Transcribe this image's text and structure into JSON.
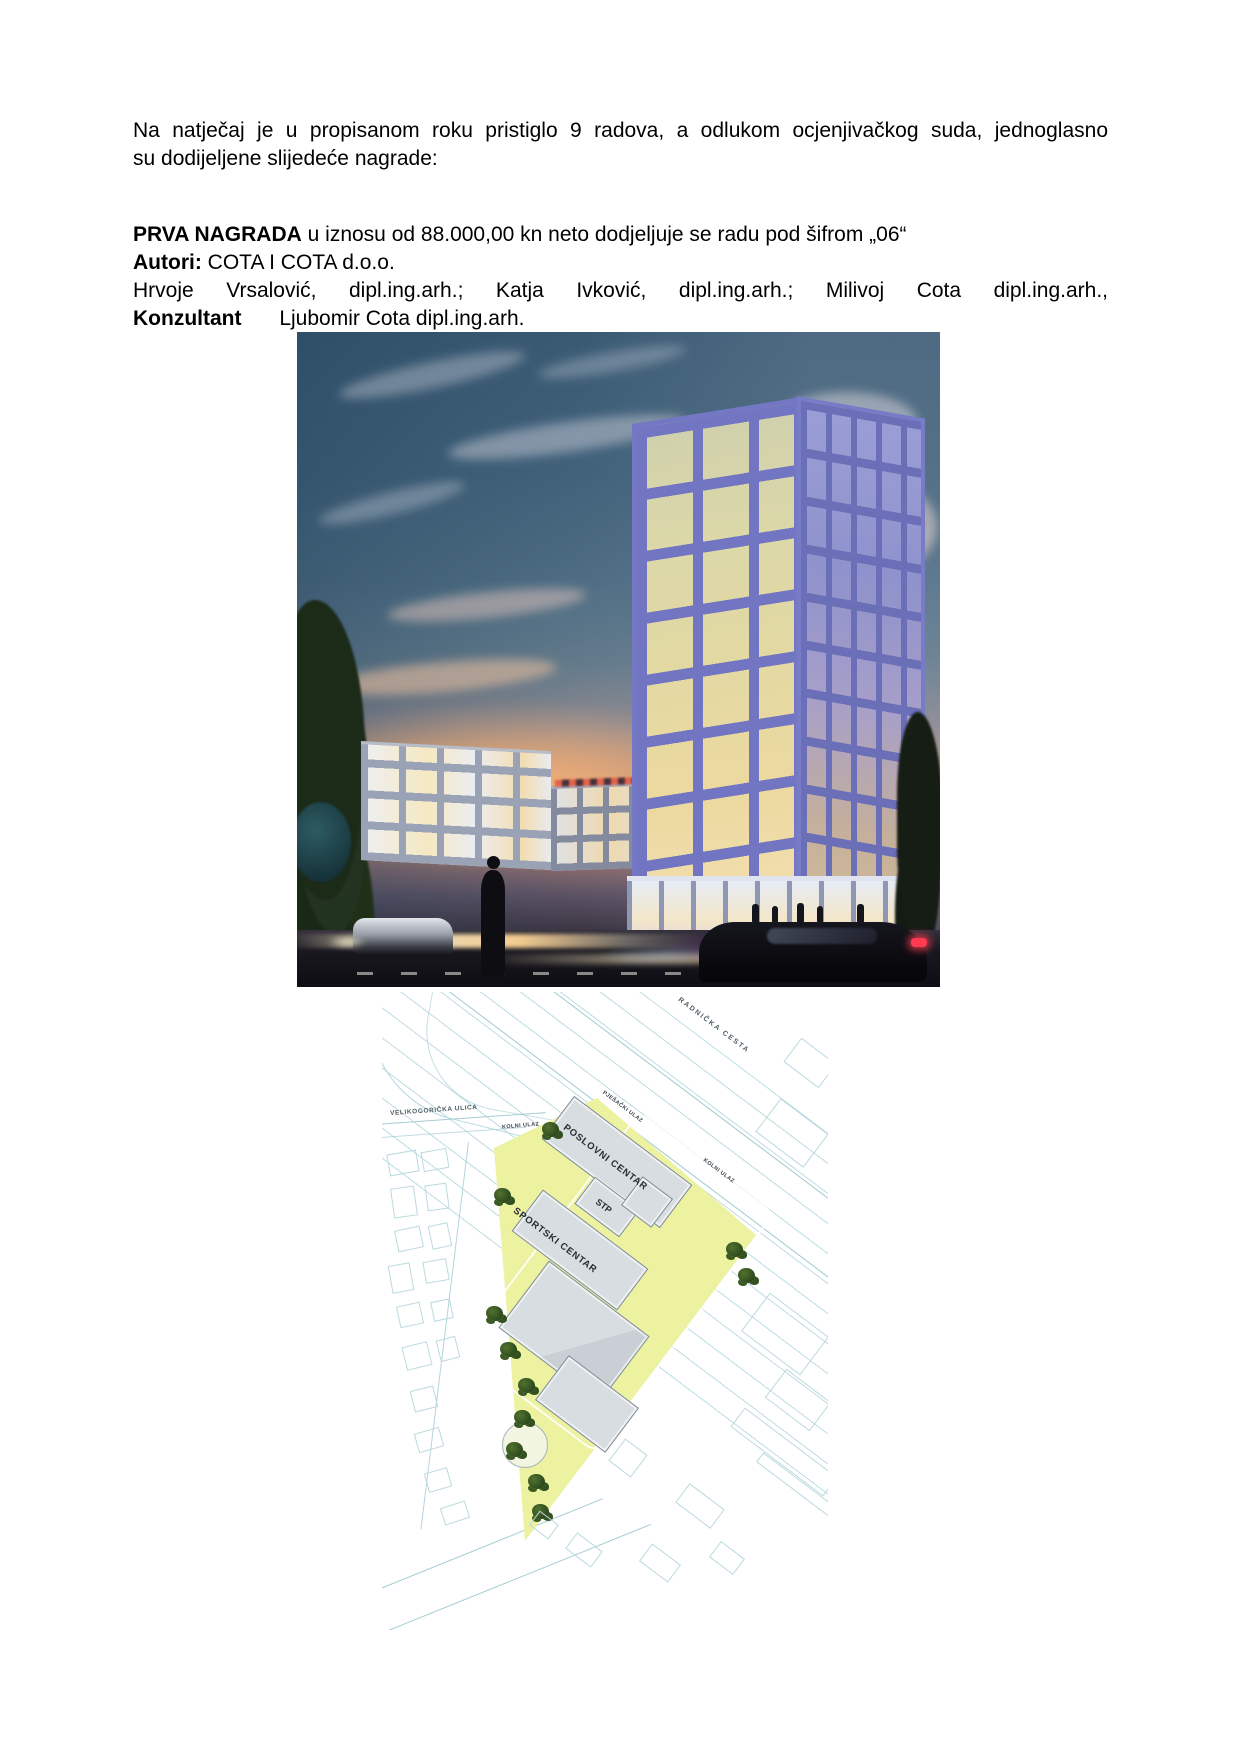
{
  "document": {
    "intro_line1": "Na natječaj je u propisanom roku pristiglo 9 radova, a odlukom ocjenjivačkog suda, jednoglasno",
    "intro_line2": "su dodijeljene slijedeće nagrade:",
    "prize_label": "PRVA NAGRADA",
    "prize_text": "u iznosu od 88.000,00 kn neto dodjeljuje se radu pod šifrom „06“",
    "authors_label": "Autori:",
    "authors_company": "COTA I COTA d.o.o.",
    "authors_people": "Hrvoje Vrsalović, dipl.ing.arh.; Katja Ivković, dipl.ing.arh.; Milivoj Cota dipl.ing.arh.,",
    "consultant_label": "Konzultant",
    "consultant_name": "Ljubomir Cota dipl.ing.arh."
  },
  "siteplan": {
    "road_label": "RADNIČKA CESTA",
    "street_label": "VELIKOGORIČKA ULICA",
    "entrance_label_west": "KOLNI ULAZ",
    "entrance_label_pedestrian": "PJEŠAČKI ULAZ",
    "entrance_label_east": "KOLNI ULAZ",
    "building_labels": [
      "POSLOVNI CENTAR",
      "STP",
      "SPORTSKI CENTAR"
    ]
  },
  "colors": {
    "site_fill": "#edf2a0",
    "plan_line": "#b3d6dd",
    "building_fill": "#d8dde1",
    "tree_green": "#2b481c",
    "sky_blue": "#42627b",
    "sunset_orange": "#d99d74",
    "tower_frame": "#7478c4",
    "tower_glass_warm": "#e3d9a2"
  }
}
